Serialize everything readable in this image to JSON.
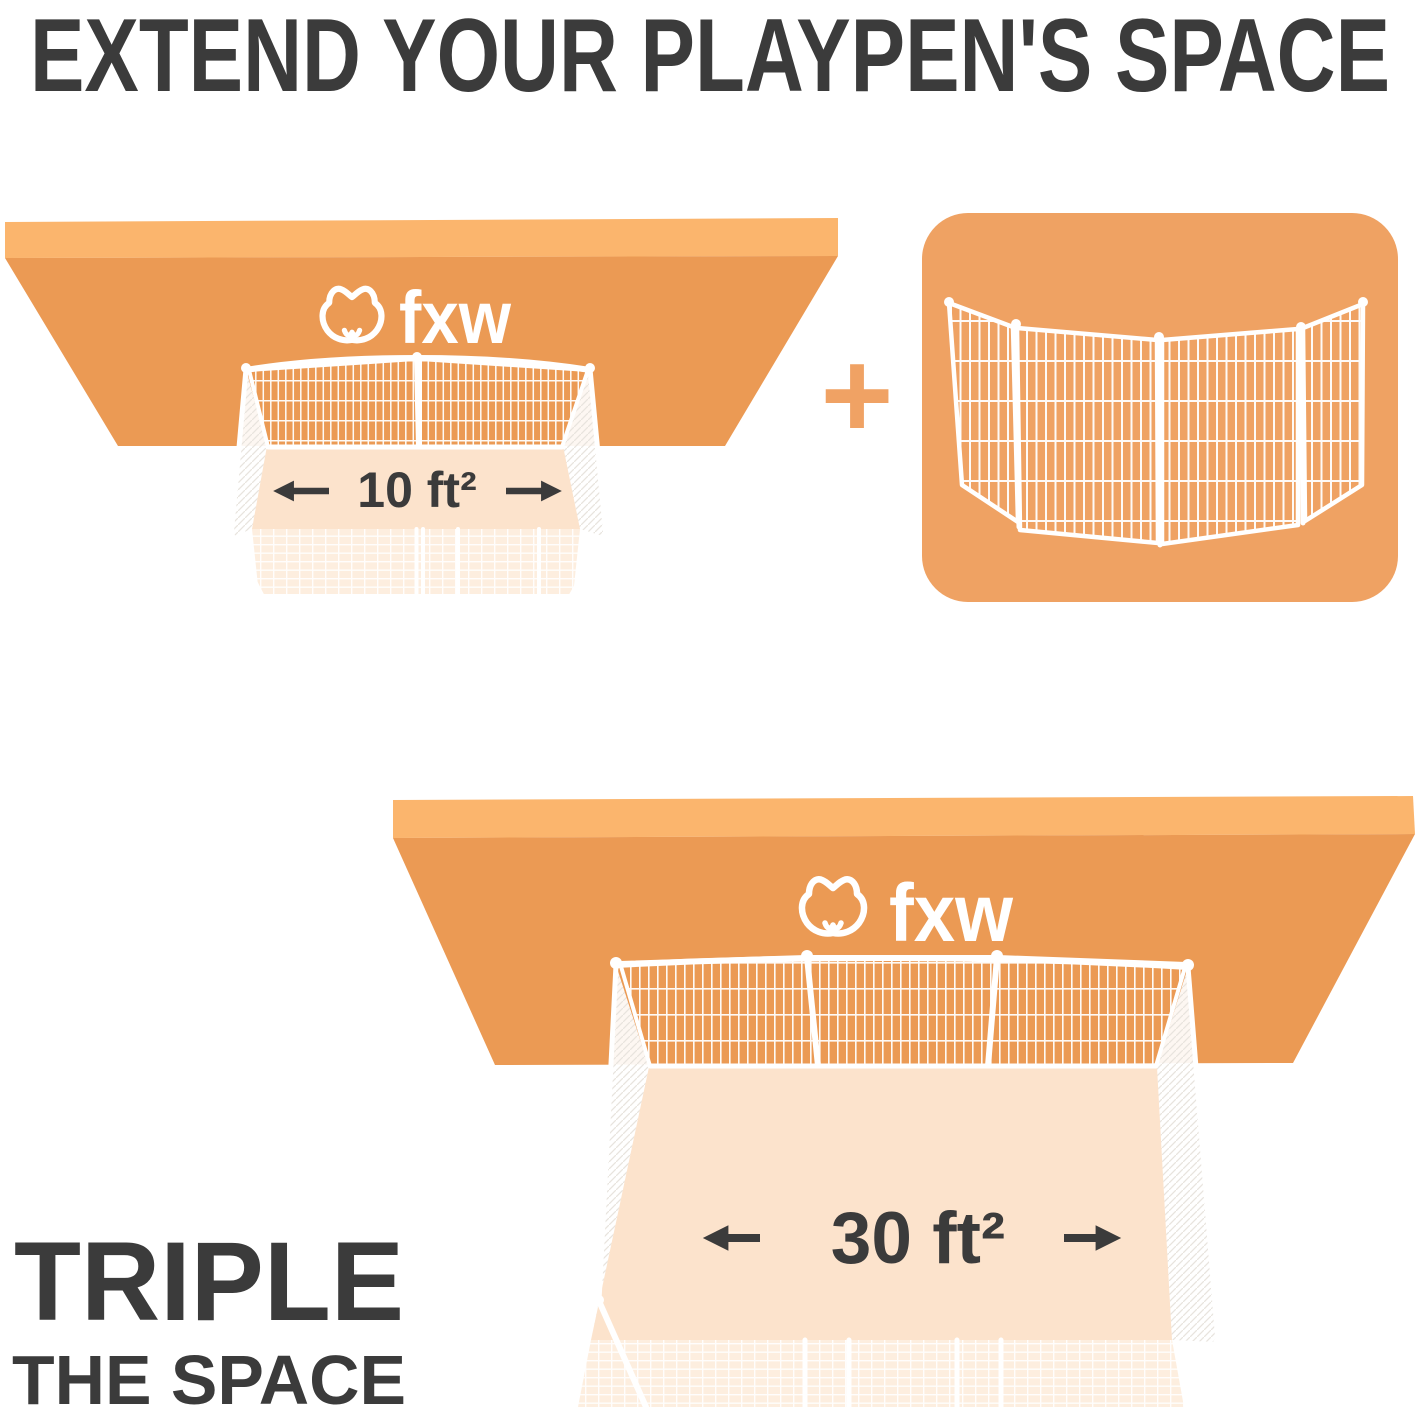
{
  "title": "EXTEND YOUR PLAYPEN'S SPACE",
  "brand": {
    "logo_text": "fxw"
  },
  "before": {
    "area_label": "10 ft²"
  },
  "plus_sign": "+",
  "after": {
    "area_label": "30 ft²"
  },
  "caption": {
    "line1": "TRIPLE",
    "line2": "THE SPACE"
  },
  "colors": {
    "board_face": "#EB9A54",
    "board_top": "#FBB56D",
    "card_bg": "#EFA263",
    "floor": "#FCE3CC",
    "floor_front": "#FDEEDF",
    "wire": "#FFFFFF",
    "text_dark": "#3B3B3B",
    "plus": "#F0A264"
  }
}
